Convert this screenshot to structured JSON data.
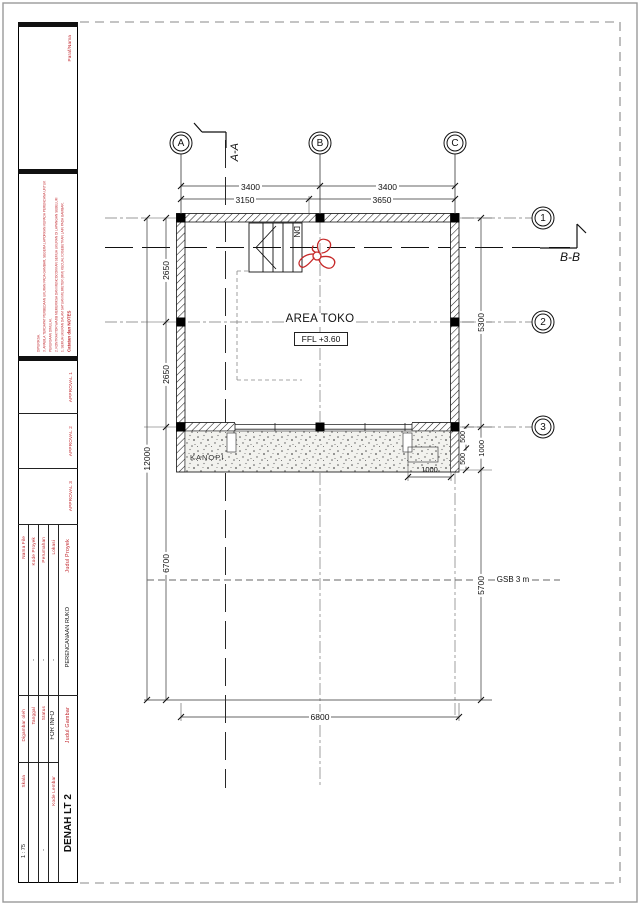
{
  "colors": {
    "red": "#c1272d",
    "line": "#111111"
  },
  "titleblock": {
    "paraf_label": "Paraf/Nama",
    "notes": {
      "header": "Catatan dan NOTES",
      "lines": [
        "1. SEMUA UKURAN DALAM SATUAN MILIMETER (MM) KECUALI DISEBUTKAN LAIN PADA GAMBAR.",
        "2. KONTRAKTOR WAJIB MEMERIKSA DAN MENCOCOKKAN SEMUA UKURAN DI LAPANGAN SEBELUM PEKERJAAN DIMULAI.",
        "3. APABILA TERDAPAT PERBEDAAN UKURAN PADA GAMBAR, SEGERA LAPORKAN KEPADA PERENCANA UNTUK DIPERIKSA."
      ]
    },
    "approvals": [
      "APPROVAL 1",
      "APPROVAL 2",
      "APPROVAL 3"
    ],
    "project": {
      "judul_proyek_label": "Judul Proyek",
      "judul_proyek_value": "PERENCANAAN RUKO",
      "lokasi_label": "Lokasi",
      "lokasi_value": "-",
      "perumahan_label": "Perumahan",
      "perumahan_value": "-",
      "kode_proyek_label": "Kode Proyek",
      "kode_proyek_value": "-",
      "nama_file_label": "Nama File",
      "nama_file_value": ""
    },
    "drawing_info": {
      "judul_gambar_label": "Judul Gambar",
      "judul_gambar_value": "DENAH LT 2",
      "status_label": "Status",
      "status_value": "FOR INFO",
      "kode_lembar_label": "Kode Lembar",
      "kode_lembar_value": "-",
      "tanggal_label": "Tanggal",
      "tanggal_value": "",
      "digambar_label": "Digambar oleh",
      "digambar_value": "",
      "skala_label": "Skala",
      "skala_value": "1 : 75"
    }
  },
  "plan": {
    "grid_cols": [
      "A",
      "B",
      "C"
    ],
    "grid_rows": [
      "1",
      "2",
      "3"
    ],
    "section_aa": "A-A",
    "section_bb": "B-B",
    "room_name": "AREA TOKO",
    "room_level": "FFL +3.60",
    "stair_label": "DN",
    "canopy_label": "KANOPI",
    "gsb_label": "GSB 3 m",
    "dims": {
      "top_ab": "3400",
      "top_bc": "3400",
      "top2_a": "3150",
      "top2_b": "3650",
      "left_12": "2650",
      "left_23": "2650",
      "left_total": "12000",
      "left_lower": "6700",
      "right_13": "5300",
      "right_canopy": "1000",
      "right_500a": "500",
      "right_500b": "500",
      "right_lower": "5700",
      "bottom_total": "6800",
      "canopy_width": "1000"
    }
  }
}
